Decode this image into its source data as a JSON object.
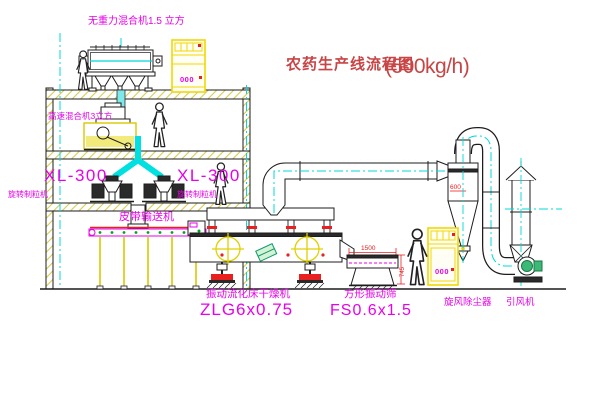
{
  "title": {
    "main": "农药生产线流程图",
    "capacity": "(500kg/h)"
  },
  "labels": {
    "gravity_mixer": "无重力混合机1.5 立方",
    "high_speed_mixer": "高速混合机3立方",
    "granulator1_model": "XL-300",
    "granulator1_name": "旋转制粒机",
    "granulator2_model": "XL-300",
    "granulator2_name": "旋转制粒机",
    "belt_conveyor": "皮带输送机",
    "dryer_name": "振动流化床干燥机",
    "dryer_model": "ZLG6x0.75",
    "sieve_name": "方形振动筛",
    "sieve_model": "FS0.6x1.5",
    "cyclone": "旋风除尘器",
    "fan": "引风机"
  },
  "dimensions": {
    "sieve_length": "1500",
    "sieve_height": "745",
    "cyclone_diameter": "600"
  },
  "panels": {
    "cabinet1_display": "000",
    "cabinet2_display": "000"
  },
  "colors": {
    "line": "#1c1c1c",
    "magenta": "#e800e8",
    "red": "#e82020",
    "title_red": "#c94444",
    "yellow": "#e8d400",
    "cyan": "#00d8d8",
    "green": "#00a020",
    "background": "#ffffff"
  }
}
